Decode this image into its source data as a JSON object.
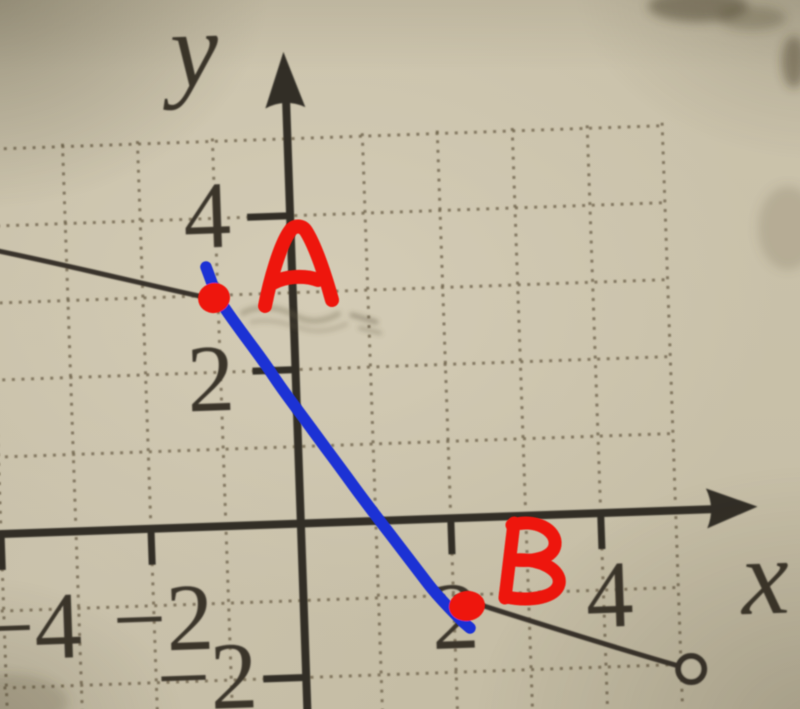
{
  "figure_type": "photographed textbook graph with hand annotations",
  "colors": {
    "paper": "#cbc3ac",
    "ink": "#39332b",
    "grid_dots": "#665b43",
    "blue_pen": "#1d33d4",
    "red_pen": "#ee1409"
  },
  "axis_labels": {
    "x": "x",
    "y": "y"
  },
  "tick_labels": {
    "y_4": "4",
    "y_2": "2",
    "y_neg2": "−2",
    "x_neg4": "−4",
    "x_neg2": "−2",
    "x_2": "2",
    "x_4": "4"
  },
  "annotations": {
    "point_a_label": "A",
    "point_b_label": "B"
  },
  "chart_data": {
    "type": "line",
    "title": "Piecewise linear function graph (textbook photo) with hand-drawn segment from A to B",
    "xlabel": "x",
    "ylabel": "y",
    "x_ticks": [
      -4,
      -2,
      2,
      4
    ],
    "y_ticks": [
      4,
      2,
      -2
    ],
    "xlim": [
      -4.1,
      6.1
    ],
    "ylim": [
      -2.6,
      6.2
    ],
    "grid": "dotted, 1-unit spacing, x from -4 to 5, y from -2 to 5",
    "legend": "none",
    "series": [
      {
        "name": "printed-left-ray",
        "style": "solid dark ink",
        "points": [
          [
            -3.9,
            3.72
          ],
          [
            -1,
            3
          ]
        ]
      },
      {
        "name": "hand-drawn-segment-AB",
        "style": "blue marker pen",
        "points": [
          [
            -1,
            3
          ],
          [
            2,
            -1
          ]
        ]
      },
      {
        "name": "printed-right-segment",
        "style": "solid dark ink, open circle at right end",
        "points": [
          [
            2,
            -1
          ],
          [
            5,
            -2
          ]
        ]
      }
    ],
    "marked_points": [
      {
        "label": "A",
        "x": -1,
        "y": 3,
        "marker": "red dot"
      },
      {
        "label": "B",
        "x": 2,
        "y": -1,
        "marker": "red dot"
      }
    ],
    "open_circle": {
      "x": 5,
      "y": -2
    }
  }
}
